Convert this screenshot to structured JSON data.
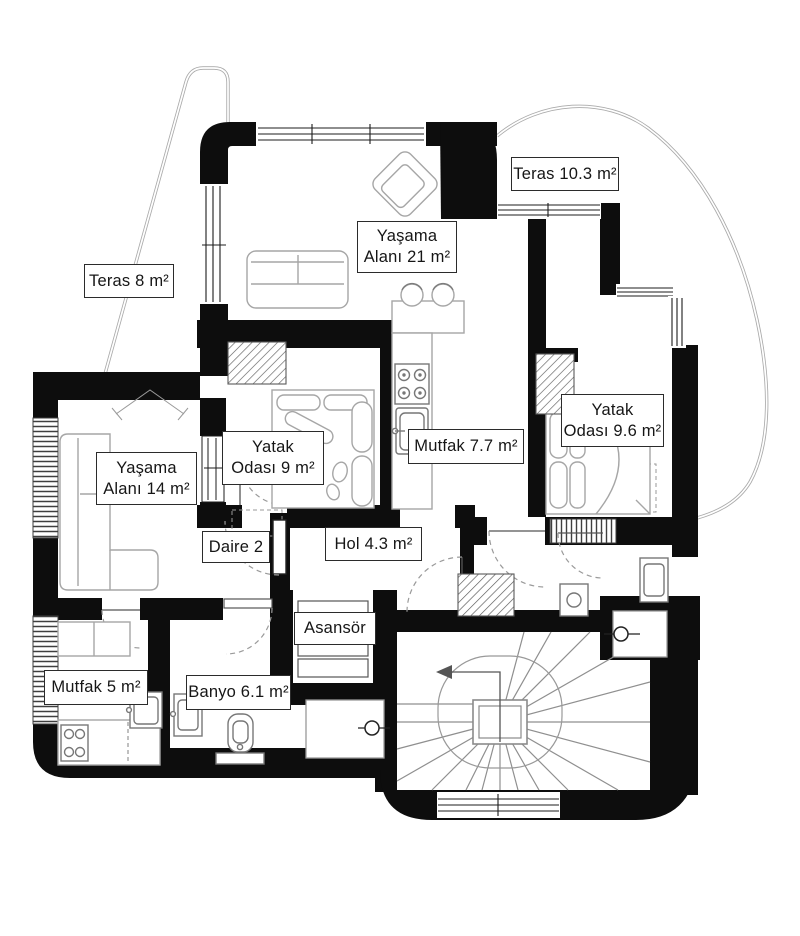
{
  "plan": {
    "labels": [
      {
        "id": "teras-right",
        "text": "Teras 10.3 m²"
      },
      {
        "id": "yasama-21",
        "line1": "Yaşama",
        "line2": "Alanı 21 m²"
      },
      {
        "id": "teras-left",
        "text": "Teras 8 m²"
      },
      {
        "id": "yatak-9",
        "line1": "Yatak",
        "line2": "Odası 9 m²"
      },
      {
        "id": "mutfak-7-7",
        "text": "Mutfak 7.7 m²"
      },
      {
        "id": "yatak-9-6",
        "line1": "Yatak",
        "line2": "Odası 9.6 m²"
      },
      {
        "id": "yasama-14",
        "line1": "Yaşama",
        "line2": "Alanı 14 m²"
      },
      {
        "id": "daire-2",
        "text": "Daire 2"
      },
      {
        "id": "hol",
        "text": "Hol 4.3 m²"
      },
      {
        "id": "asansor",
        "text": "Asansör"
      },
      {
        "id": "mutfak-5",
        "text": "Mutfak 5 m²"
      },
      {
        "id": "banyo",
        "text": "Banyo 6.1 m²"
      }
    ],
    "colors": {
      "background": "#ffffff",
      "wall": "#0d0d0d",
      "furniture_line": "#a6a6a6",
      "label_border": "#2b2b2b",
      "terrace_line": "#b3b3b3"
    }
  }
}
